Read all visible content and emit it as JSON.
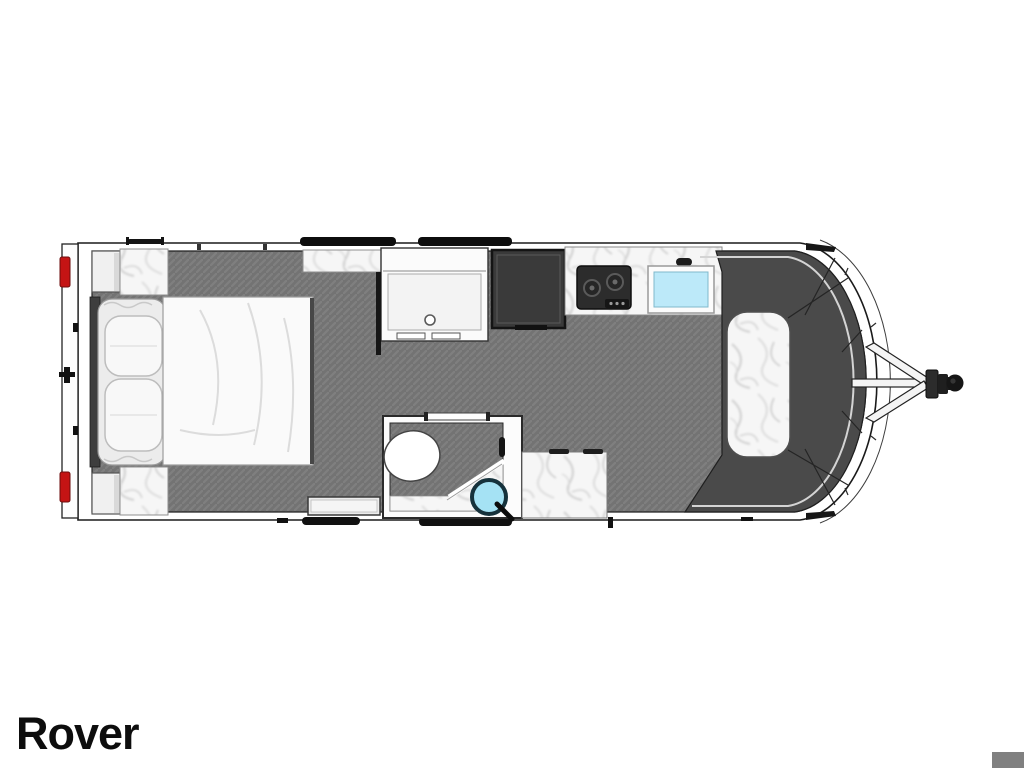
{
  "title": "Rover",
  "colors": {
    "background": "#ffffff",
    "outline": "#1a1a1a",
    "wall": "#ffffff",
    "floor_base": "#737373",
    "floor_hatch": "#7f7f7f",
    "seat": "#4a4a4a",
    "marble_base": "#f6f6f6",
    "headboard": "#3e3e3e",
    "bed_frame": "#ececec",
    "pillow": "#f8f8f8",
    "mattress": "#fafafa",
    "nightstand": "#f0f0f0",
    "wardrobe": "#fbfbfb",
    "fridge": "#3a3a3a",
    "cooktop": "#2c2c2c",
    "sink_fill": "#bce9f9",
    "basin_fill": "#a5e2f4",
    "basin_ring": "#16323c",
    "tail_light": "#c41414",
    "hardware": "#111111",
    "step": "#ececec",
    "accent_square": "#808080",
    "title_color": "#0d0d0d"
  },
  "floorplan": {
    "model_label": "Rover",
    "features": [
      "rear-bumper",
      "tail-lights",
      "bed",
      "pillows",
      "nightstands",
      "wardrobe",
      "refrigerator",
      "kitchen-counter",
      "cooktop",
      "kitchen-sink",
      "bathroom",
      "toilet",
      "shower",
      "wash-basin",
      "bathroom-counter",
      "entry-step",
      "front-lounge-seating",
      "dinette-table",
      "a-frame-hitch",
      "tow-coupler",
      "awning-rails"
    ]
  }
}
